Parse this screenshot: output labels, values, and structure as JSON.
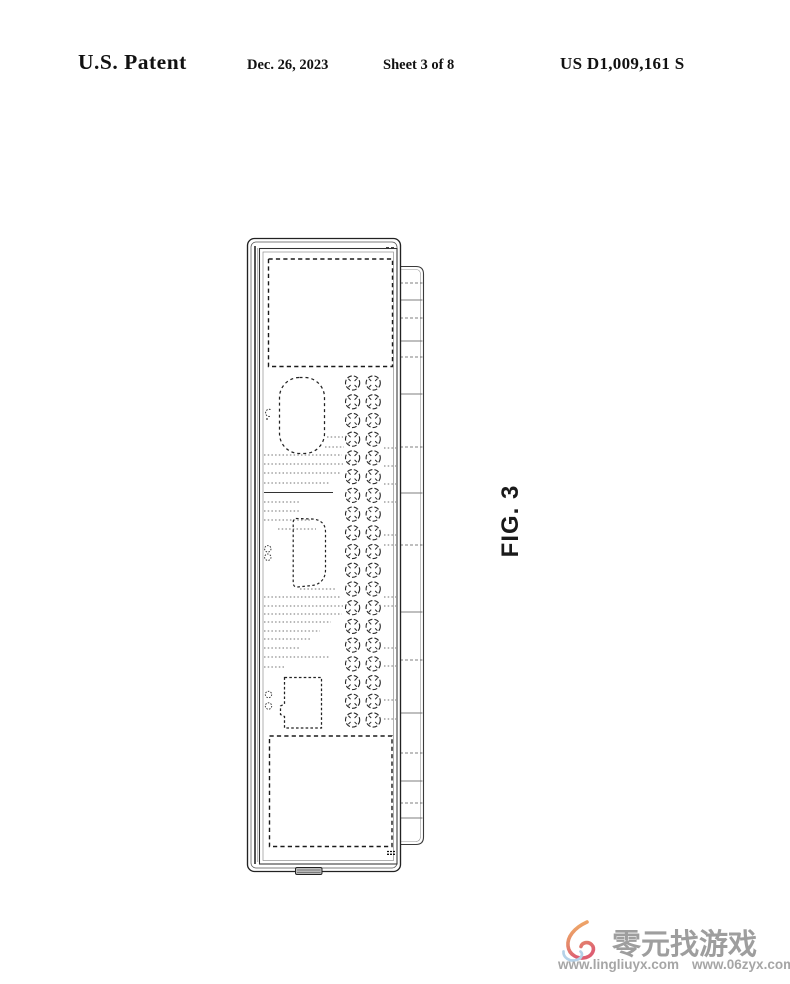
{
  "page": {
    "background": "#ffffff"
  },
  "header": {
    "title": "U.S. Patent",
    "date": "Dec. 26, 2023",
    "sheet": "Sheet 3 of 8",
    "publication_number": "US D1,009,161 S"
  },
  "figure": {
    "label": "FIG. 3",
    "vents": {
      "rows": 19,
      "cols": 2
    }
  },
  "watermark": {
    "site_name": "零元找游戏",
    "urls": [
      "www.lingliuyx.com",
      "www.06zyx.com"
    ],
    "text_color": "#9e9e9e",
    "logo_colors": {
      "flame_top": "#f2b066",
      "flame_body": "#e06a6a",
      "swirl": "#b5d2e8"
    }
  }
}
